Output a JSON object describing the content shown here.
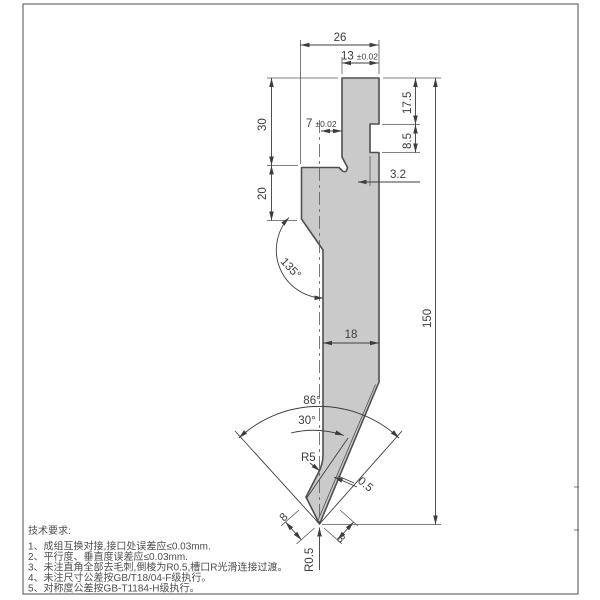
{
  "drawing": {
    "part_fill": "#cacaca",
    "outline_color": "#4f4f4f",
    "dim_color": "#3d3d3d"
  },
  "dimensions": {
    "top_width": "26",
    "tang_width": "13",
    "tang_width_tol": "±0.02",
    "shoulder_height": "17.5",
    "notch_height": "8.5",
    "total_height": "150",
    "notch_depth": "3.2",
    "upper_left_height": "30",
    "lower_left_height": "20",
    "center_offset": "7",
    "center_offset_tol": "±0.02",
    "taper_angle": "135°",
    "body_width": "18",
    "tip_angle": "86°",
    "relief_angle": "30°",
    "relief_radius": "R5",
    "land_width": "0.5",
    "left_face": "8",
    "right_face": "8",
    "tip_radius": "R0.5"
  },
  "notes": {
    "title": "技术要求:",
    "items": [
      "1、成组互换对接,接口处误差应≤0.03mm.",
      "2、平行度、垂直度误差应≤0.03mm.",
      "3、未注直角全部去毛刺,倒棱为R0.5,槽口R光滑连接过渡。",
      "4、未注尺寸公差按GB/T18/04-F级执行。",
      "5、对称度公差按GB-T1184-H级执行。"
    ]
  }
}
